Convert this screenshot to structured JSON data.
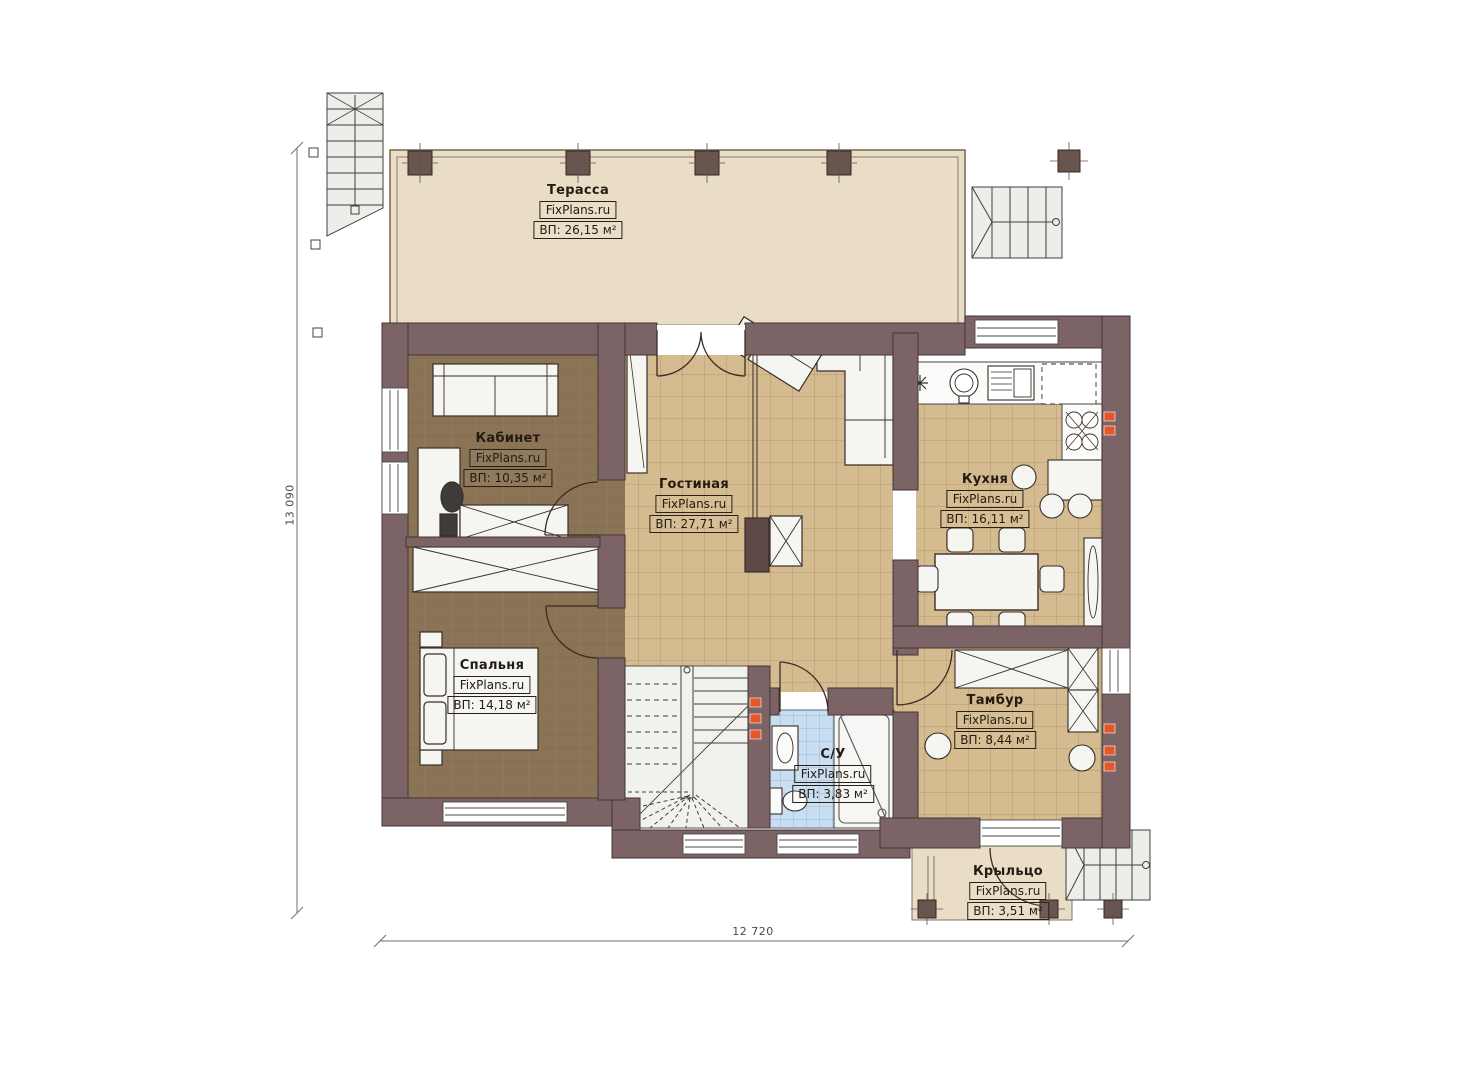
{
  "meta": {
    "plan_type": "floor-plan",
    "brand": "FixPlans.ru"
  },
  "rooms": [
    {
      "id": "terrace",
      "name": "Терасса",
      "brand": "FixPlans.ru",
      "area": "ВП: 26,15 м²"
    },
    {
      "id": "office",
      "name": "Кабинет",
      "brand": "FixPlans.ru",
      "area": "ВП: 10,35 м²"
    },
    {
      "id": "living",
      "name": "Гостиная",
      "brand": "FixPlans.ru",
      "area": "ВП: 27,71 м²"
    },
    {
      "id": "kitchen",
      "name": "Кухня",
      "brand": "FixPlans.ru",
      "area": "ВП: 16,11 м²"
    },
    {
      "id": "bedroom",
      "name": "Спальня",
      "brand": "FixPlans.ru",
      "area": "ВП: 14,18 м²"
    },
    {
      "id": "vestibule",
      "name": "Тамбур",
      "brand": "FixPlans.ru",
      "area": "ВП: 8,44 м²"
    },
    {
      "id": "bathroom",
      "name": "С/У",
      "brand": "FixPlans.ru",
      "area": "ВП: 3,83 м²"
    },
    {
      "id": "porch",
      "name": "Крыльцо",
      "brand": "FixPlans.ru",
      "area": "ВП: 3,51 м²"
    }
  ],
  "dimensions": {
    "bottom": "12 720",
    "left": "13 090"
  },
  "colors": {
    "wall": "#7c6366",
    "wood": "#8b7356",
    "tile": "#d4bb90",
    "tile_line": "#a98e60",
    "bath": "#cadef1",
    "terrace": "#e9ddc6",
    "accent": "#e2572b",
    "ink": "#2b2014"
  }
}
